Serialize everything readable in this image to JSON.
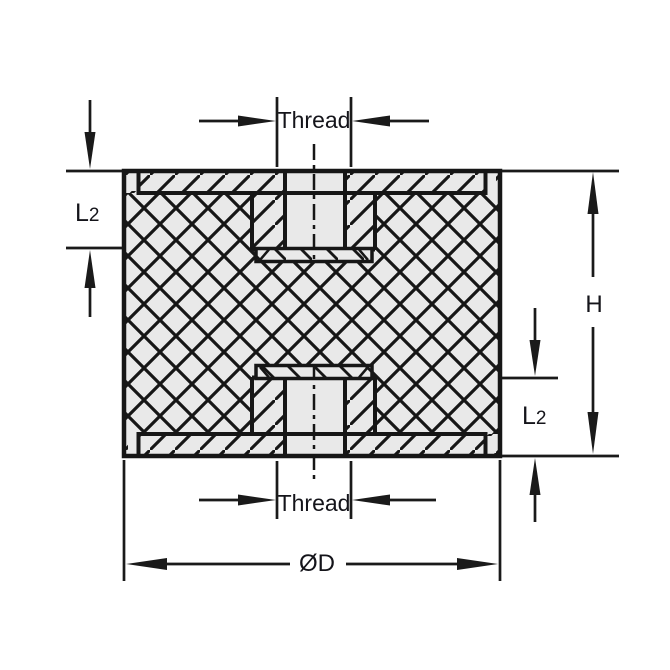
{
  "drawing": {
    "kind": "technical cross-section drawing",
    "dimensions": {
      "thread_top": {
        "label": "Thread"
      },
      "thread_bottom": {
        "label": "Thread"
      },
      "depth_left": {
        "label": "L2",
        "main": "L",
        "sub": "2"
      },
      "depth_right": {
        "label": "L2",
        "main": "L",
        "sub": "2"
      },
      "height": {
        "label": "H"
      },
      "diameter": {
        "label": "ØD"
      }
    },
    "colors": {
      "line": "#1a1a1a",
      "section_fill": "#e9e9e9",
      "text": "#14141a",
      "background": "#ffffff"
    }
  }
}
